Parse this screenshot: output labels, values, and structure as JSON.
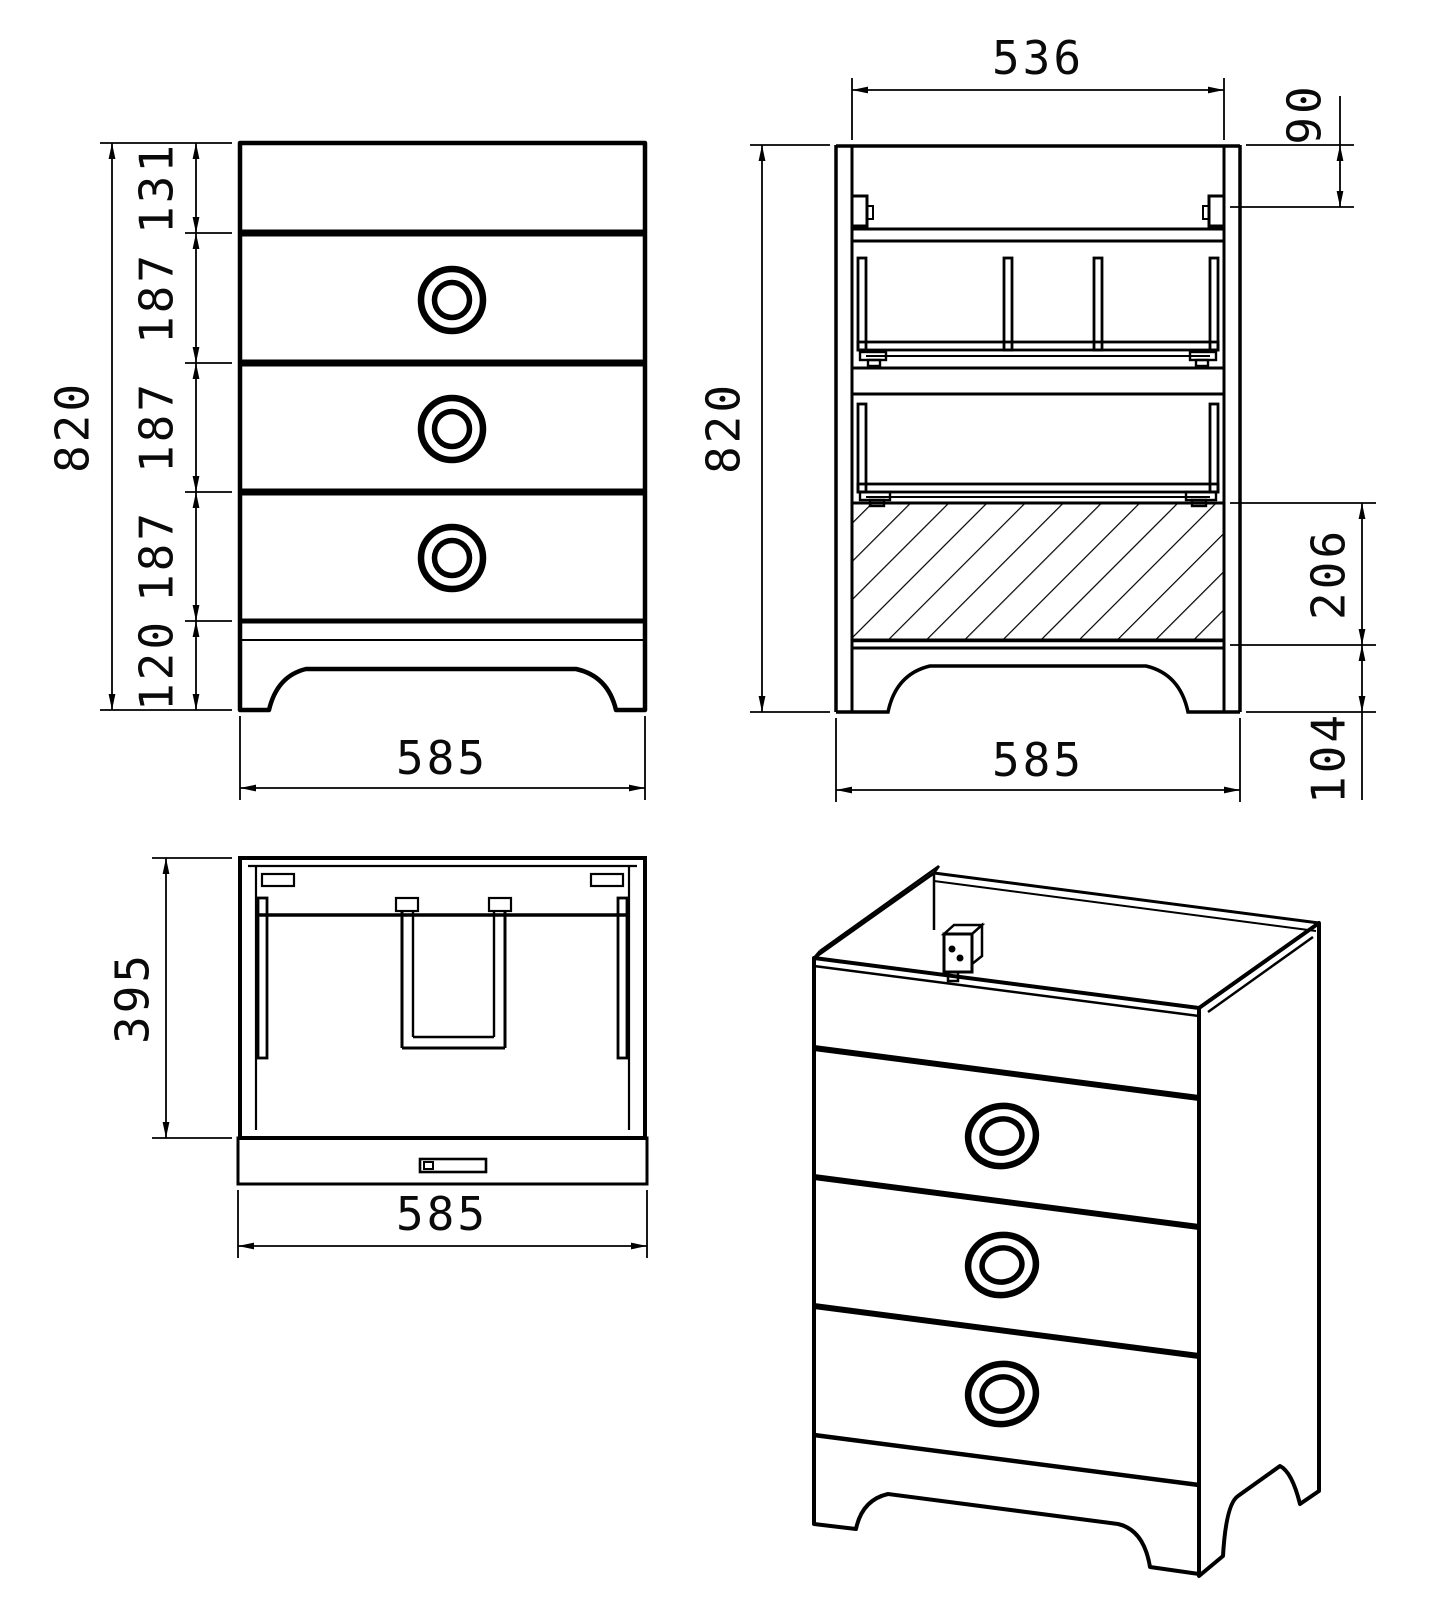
{
  "drawing": {
    "type": "technical-drawing",
    "subject": "three-drawer sink vanity cabinet",
    "colors": {
      "line": "#000000",
      "background": "#ffffff"
    },
    "views": {
      "front": {
        "label": "front-view",
        "height_total": "820",
        "segments": [
          "131",
          "187",
          "187",
          "187",
          "120"
        ],
        "width": "585"
      },
      "section": {
        "label": "section-view",
        "inner_width": "536",
        "bracket_offset": "90",
        "height_total": "820",
        "drawer_front_height": "206",
        "plinth_height": "104",
        "width": "585"
      },
      "top": {
        "label": "top-view",
        "depth": "395",
        "width": "585"
      },
      "isometric": {
        "label": "isometric-view"
      }
    }
  }
}
